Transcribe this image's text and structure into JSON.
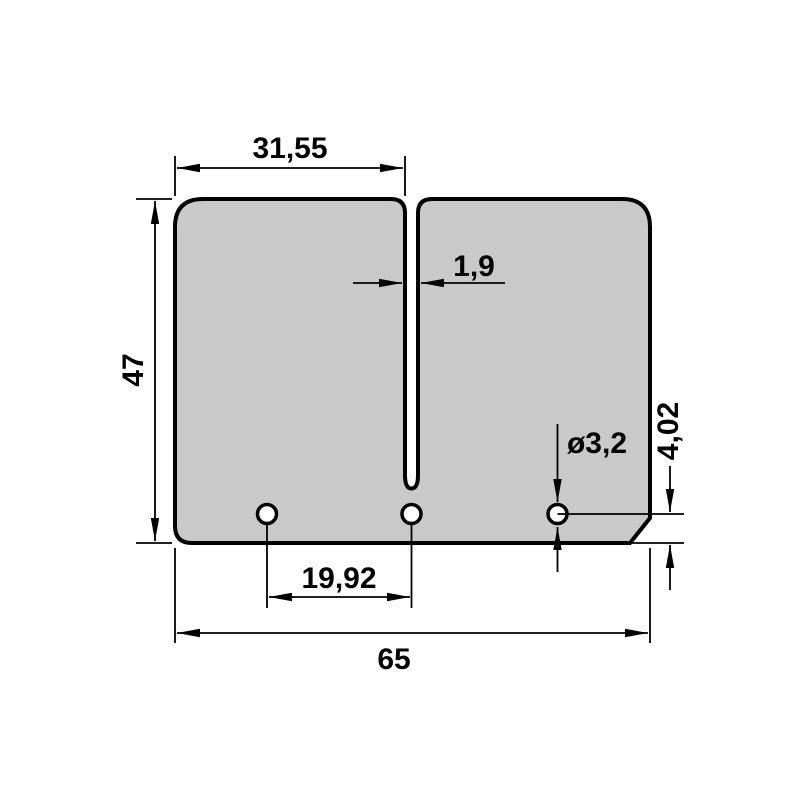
{
  "colors": {
    "background": "#ffffff",
    "plate_fill": "#c9c9c9",
    "hole_fill": "#ffffff",
    "line": "#000000"
  },
  "dimensions": {
    "top_width": {
      "label": "31,55",
      "value": 31.55
    },
    "slot_width": {
      "label": "1,9",
      "value": 1.9
    },
    "height": {
      "label": "47",
      "value": 47
    },
    "hole_diameter": {
      "label": "ø3,2",
      "value": 3.2
    },
    "hole_offset_bottom": {
      "label": "4,02",
      "value": 4.02
    },
    "hole_spacing": {
      "label": "19,92",
      "value": 19.92
    },
    "total_width": {
      "label": "65",
      "value": 65
    }
  }
}
